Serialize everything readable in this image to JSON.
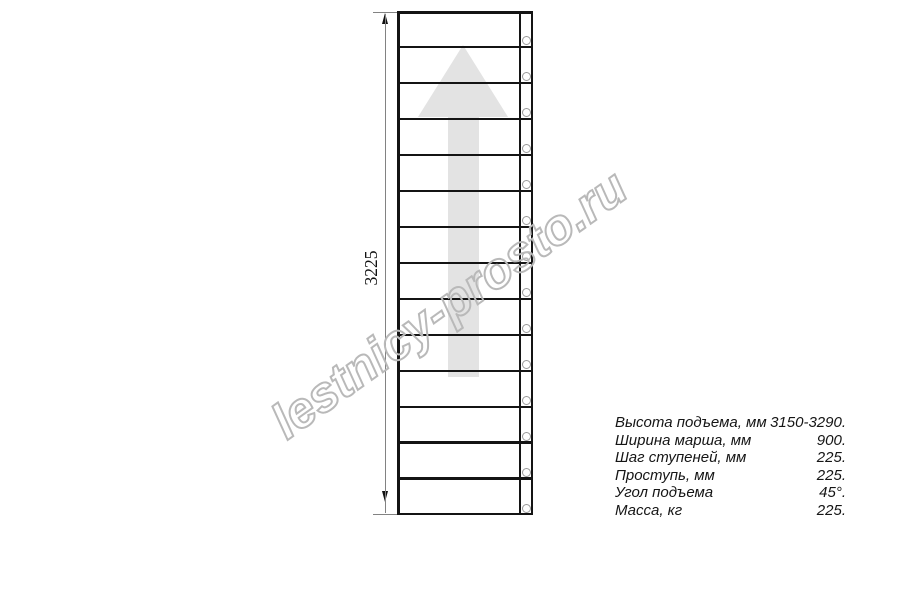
{
  "drawing": {
    "dimension_label": "3225",
    "steps_count": 14,
    "arrow_direction": "up"
  },
  "watermark": {
    "text": "lestnicy-prosto.ru"
  },
  "specs": {
    "rows": [
      {
        "label": "Высота подъема, мм",
        "value": "3150-3290."
      },
      {
        "label": "Ширина марша, мм",
        "value": "900."
      },
      {
        "label": "Шаг ступеней, мм",
        "value": "225."
      },
      {
        "label": "Проступь, мм",
        "value": "225."
      },
      {
        "label": "Угол подъема",
        "value": "45°."
      },
      {
        "label": "Масса, кг",
        "value": "225."
      }
    ]
  },
  "colors": {
    "line": "#141414",
    "arrow_fill": "#e3e3e3",
    "dimension": "#828282",
    "screw_stroke": "#9a9a9a",
    "watermark_stroke": "#b9b9b9",
    "background": "#ffffff"
  }
}
